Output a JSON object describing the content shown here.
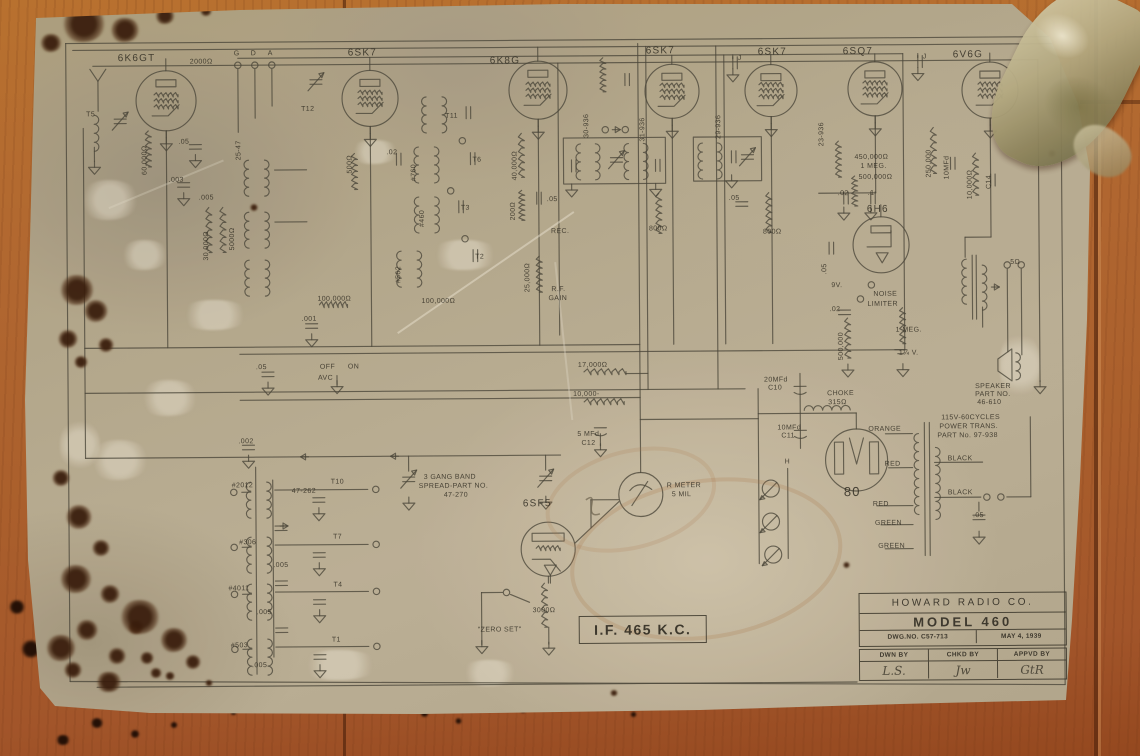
{
  "colors": {
    "ink": "#45443a",
    "paper": "#b4aa92",
    "wood": "#b2682f"
  },
  "schematic": {
    "tubes": [
      {
        "label": "6K6GT",
        "x": 168,
        "y": 98,
        "r": 30,
        "lx": 120,
        "ly": 51,
        "kind": "pent"
      },
      {
        "label": "6SK7",
        "x": 372,
        "y": 97,
        "r": 28,
        "lx": 350,
        "ly": 47,
        "kind": "pent"
      },
      {
        "label": "6K8G",
        "x": 540,
        "y": 90,
        "r": 29,
        "lx": 492,
        "ly": 56,
        "kind": "pent"
      },
      {
        "label": "6SK7",
        "x": 674,
        "y": 92,
        "r": 27,
        "lx": 648,
        "ly": 47,
        "kind": "pent"
      },
      {
        "label": "6SK7",
        "x": 773,
        "y": 92,
        "r": 26,
        "lx": 760,
        "ly": 49,
        "kind": "pent"
      },
      {
        "label": "6SQ7",
        "x": 877,
        "y": 91,
        "r": 27,
        "lx": 845,
        "ly": 49,
        "kind": "pent"
      },
      {
        "label": "6V6G",
        "x": 992,
        "y": 93,
        "r": 28,
        "lx": 955,
        "ly": 53,
        "kind": "pent"
      },
      {
        "label": "6H6",
        "x": 882,
        "y": 247,
        "r": 28,
        "lx": 868,
        "ly": 207,
        "kind": "diode"
      },
      {
        "label": "6SF5",
        "x": 547,
        "y": 549,
        "r": 27,
        "lx": 522,
        "ly": 499,
        "kind": "tri"
      },
      {
        "label": "80",
        "x": 856,
        "y": 462,
        "r": 31,
        "lx": 843,
        "ly": 487,
        "kind": "rect80",
        "big": true
      }
    ],
    "meter": {
      "x": 640,
      "y": 495,
      "r": 22,
      "label1": "R METER",
      "label2": "5 MIL"
    },
    "if_box": {
      "text": "I.F. 465 K.C."
    },
    "title_block": {
      "company": "HOWARD RADIO CO.",
      "model": "MODEL 460",
      "dwg_no": "DWG.NO. C57-713",
      "date": "MAY 4, 1939",
      "col_headers": [
        "DWN BY",
        "CHKD BY",
        "APPVD BY"
      ],
      "signatures": [
        "L.S.",
        "Jw",
        "GtR"
      ]
    },
    "labels": [
      {
        "t": "G",
        "x": 236,
        "y": 48
      },
      {
        "t": "D",
        "x": 253,
        "y": 48
      },
      {
        "t": "A",
        "x": 270,
        "y": 48
      },
      {
        "t": "2000Ω",
        "x": 192,
        "y": 56
      },
      {
        "t": "T12",
        "x": 303,
        "y": 104
      },
      {
        "t": ".02",
        "x": 388,
        "y": 148
      },
      {
        "t": "500Ω",
        "x": 348,
        "y": 172,
        "v": 1
      },
      {
        "t": "T5",
        "x": 88,
        "y": 108
      },
      {
        "t": "60,000Ω",
        "x": 143,
        "y": 172,
        "v": 1
      },
      {
        "t": ".05",
        "x": 180,
        "y": 136
      },
      {
        "t": ".003",
        "x": 170,
        "y": 174
      },
      {
        "t": "30,000Ω",
        "x": 204,
        "y": 258,
        "v": 1
      },
      {
        "t": "5000Ω",
        "x": 230,
        "y": 248,
        "v": 1
      },
      {
        "t": "25-47",
        "x": 237,
        "y": 158,
        "v": 1
      },
      {
        "t": "100,000Ω",
        "x": 318,
        "y": 294
      },
      {
        "t": ".001",
        "x": 302,
        "y": 314
      },
      {
        "t": ".005",
        "x": 200,
        "y": 192
      },
      {
        "t": ".05",
        "x": 256,
        "y": 362
      },
      {
        "t": "OFF",
        "x": 320,
        "y": 362
      },
      {
        "t": "ON",
        "x": 348,
        "y": 362
      },
      {
        "t": "AVC",
        "x": 318,
        "y": 373
      },
      {
        "t": ".002",
        "x": 238,
        "y": 436
      },
      {
        "t": "T11",
        "x": 447,
        "y": 112
      },
      {
        "t": "T6",
        "x": 474,
        "y": 156
      },
      {
        "t": "T3",
        "x": 462,
        "y": 204
      },
      {
        "t": "T2",
        "x": 476,
        "y": 253
      },
      {
        "t": "#760",
        "x": 412,
        "y": 180,
        "v": 1
      },
      {
        "t": "#460",
        "x": 420,
        "y": 226,
        "v": 1
      },
      {
        "t": "#562",
        "x": 396,
        "y": 282,
        "v": 1
      },
      {
        "t": "100,000Ω",
        "x": 422,
        "y": 297
      },
      {
        "t": "40,000Ω",
        "x": 513,
        "y": 180,
        "v": 1
      },
      {
        "t": "200Ω",
        "x": 511,
        "y": 220,
        "v": 1
      },
      {
        "t": ".05",
        "x": 548,
        "y": 196
      },
      {
        "t": "REC.",
        "x": 552,
        "y": 228
      },
      {
        "t": "25,000Ω",
        "x": 525,
        "y": 292,
        "v": 1
      },
      {
        "t": "R.F.",
        "x": 552,
        "y": 286
      },
      {
        "t": "GAIN",
        "x": 549,
        "y": 295
      },
      {
        "t": "30-936",
        "x": 585,
        "y": 138,
        "v": 1
      },
      {
        "t": "31-936",
        "x": 641,
        "y": 142,
        "v": 1
      },
      {
        "t": "29-936",
        "x": 717,
        "y": 140,
        "v": 1
      },
      {
        "t": "23-936",
        "x": 820,
        "y": 148,
        "v": 1
      },
      {
        "t": "J",
        "x": 740,
        "y": 56
      },
      {
        "t": "J",
        "x": 925,
        "y": 56
      },
      {
        "t": "800Ω",
        "x": 650,
        "y": 226
      },
      {
        "t": "800Ω",
        "x": 764,
        "y": 230
      },
      {
        "t": ".05",
        "x": 730,
        "y": 196
      },
      {
        "t": "17,000Ω",
        "x": 578,
        "y": 362
      },
      {
        "t": "10,000-",
        "x": 573,
        "y": 391
      },
      {
        "t": "5 MFd",
        "x": 577,
        "y": 431
      },
      {
        "t": "C12",
        "x": 581,
        "y": 440
      },
      {
        "t": ".02",
        "x": 839,
        "y": 192
      },
      {
        "t": ".1",
        "x": 869,
        "y": 192
      },
      {
        "t": ".05",
        "x": 822,
        "y": 276,
        "v": 1
      },
      {
        "t": "9V.",
        "x": 832,
        "y": 284
      },
      {
        "t": "NOISE",
        "x": 874,
        "y": 293
      },
      {
        "t": "LIMITER",
        "x": 868,
        "y": 303
      },
      {
        "t": ".02",
        "x": 830,
        "y": 308
      },
      {
        "t": "500,000",
        "x": 838,
        "y": 362,
        "v": 1
      },
      {
        "t": "1 MEG.",
        "x": 896,
        "y": 329
      },
      {
        "t": "1¼ V.",
        "x": 899,
        "y": 352
      },
      {
        "t": "450,000Ω",
        "x": 856,
        "y": 156
      },
      {
        "t": "1 MEG.",
        "x": 862,
        "y": 165
      },
      {
        "t": "500,000Ω",
        "x": 860,
        "y": 176
      },
      {
        "t": "250,000",
        "x": 927,
        "y": 180,
        "v": 1
      },
      {
        "t": "10MFd",
        "x": 945,
        "y": 182,
        "v": 1
      },
      {
        "t": "10,000Ω",
        "x": 968,
        "y": 202,
        "v": 1
      },
      {
        "t": "C14",
        "x": 987,
        "y": 192,
        "v": 1
      },
      {
        "t": "5Ω",
        "x": 1011,
        "y": 262
      },
      {
        "t": "SPEAKER",
        "x": 975,
        "y": 386
      },
      {
        "t": "PART NO.",
        "x": 975,
        "y": 394
      },
      {
        "t": "46-610",
        "x": 977,
        "y": 402
      },
      {
        "t": "20MFd",
        "x": 764,
        "y": 378
      },
      {
        "t": "C10",
        "x": 768,
        "y": 386
      },
      {
        "t": "CHOKE",
        "x": 827,
        "y": 392
      },
      {
        "t": "315Ω",
        "x": 828,
        "y": 401
      },
      {
        "t": "10MFd",
        "x": 777,
        "y": 426
      },
      {
        "t": "C11",
        "x": 781,
        "y": 434
      },
      {
        "t": "115V-60CYCLES",
        "x": 941,
        "y": 417
      },
      {
        "t": "POWER TRANS.",
        "x": 939,
        "y": 426
      },
      {
        "t": "PART No. 97-938",
        "x": 937,
        "y": 435
      },
      {
        "t": "ORANGE",
        "x": 868,
        "y": 428
      },
      {
        "t": "RED",
        "x": 884,
        "y": 463
      },
      {
        "t": "RED",
        "x": 872,
        "y": 503
      },
      {
        "t": "GREEN",
        "x": 874,
        "y": 522
      },
      {
        "t": "GREEN",
        "x": 877,
        "y": 545
      },
      {
        "t": "BLACK",
        "x": 947,
        "y": 458
      },
      {
        "t": "BLACK",
        "x": 947,
        "y": 492
      },
      {
        "t": ".05",
        "x": 972,
        "y": 515
      },
      {
        "t": "H",
        "x": 784,
        "y": 460
      },
      {
        "t": "3 GANG BAND",
        "x": 423,
        "y": 473
      },
      {
        "t": "SPREAD-PART NO.",
        "x": 418,
        "y": 482
      },
      {
        "t": "47-270",
        "x": 443,
        "y": 491
      },
      {
        "t": "T10",
        "x": 330,
        "y": 477
      },
      {
        "t": "47-262",
        "x": 291,
        "y": 486
      },
      {
        "t": "#2012",
        "x": 231,
        "y": 480
      },
      {
        "t": "#306",
        "x": 238,
        "y": 537
      },
      {
        "t": "T7",
        "x": 332,
        "y": 532
      },
      {
        "t": ".005",
        "x": 272,
        "y": 560
      },
      {
        "t": "#4011",
        "x": 227,
        "y": 583
      },
      {
        "t": "T4",
        "x": 332,
        "y": 580
      },
      {
        "t": ".005",
        "x": 255,
        "y": 607
      },
      {
        "t": "#503",
        "x": 229,
        "y": 640
      },
      {
        "t": "T1",
        "x": 330,
        "y": 635
      },
      {
        "t": ".005",
        "x": 250,
        "y": 660
      },
      {
        "t": "3000Ω",
        "x": 531,
        "y": 607
      },
      {
        "t": "\"ZERO SET\"",
        "x": 476,
        "y": 626
      }
    ]
  }
}
